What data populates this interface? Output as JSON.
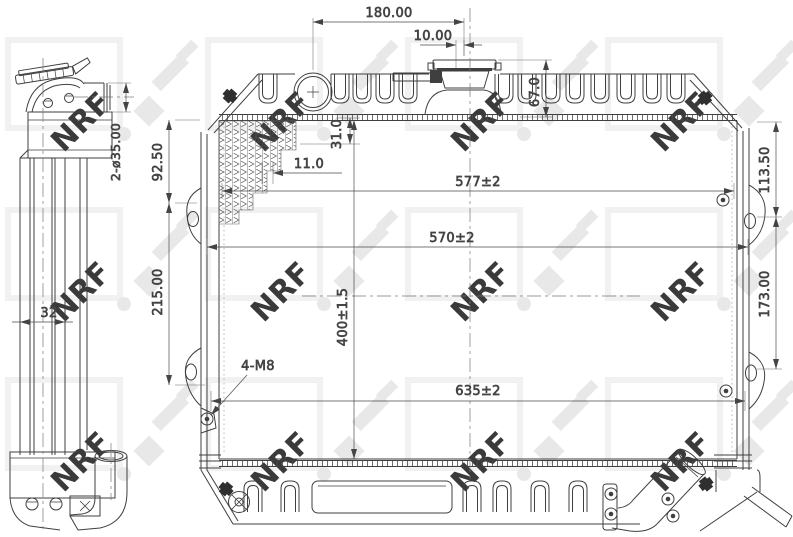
{
  "watermark": {
    "brand": "NRF"
  },
  "dimensions": {
    "side_view": {
      "pipe_diameter": "2-ø35.00",
      "core_depth": "32"
    },
    "front_view": {
      "filler_to_cap": "180.00",
      "cap_offset": "10.00",
      "top_tank_height": "67.0",
      "header_depth": "31.0",
      "fin_inset": "11.0",
      "left_upper_height": "92.50",
      "left_lower_height": "215.00",
      "core_width_upper": "577±2",
      "core_width_lower": "570±2",
      "core_height": "400±1.5",
      "mounting_bolts": "4-M8",
      "overall_width": "635±2",
      "right_upper_height": "113.50",
      "right_lower_height": "173.00"
    }
  }
}
